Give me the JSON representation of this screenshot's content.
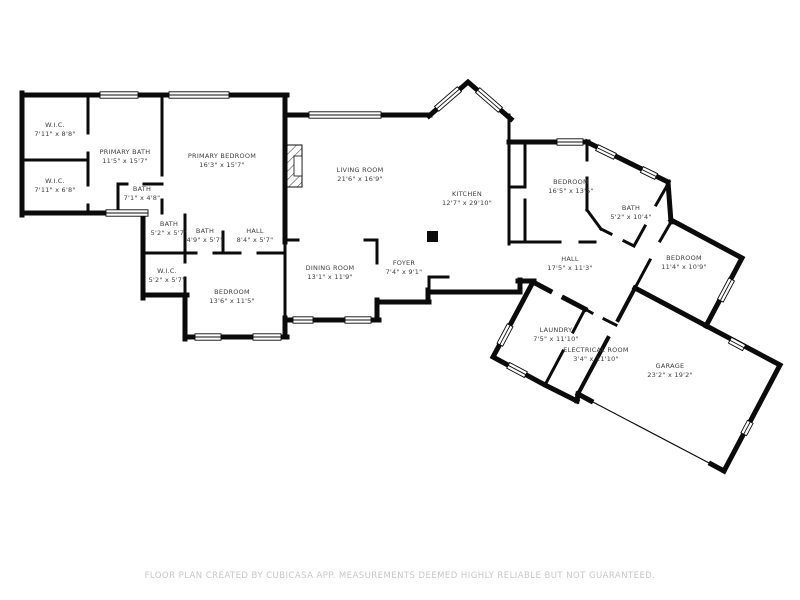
{
  "plan": {
    "app_credit": "CUBICASA",
    "footer": "FLOOR PLAN CREATED BY CUBICASA APP. MEASUREMENTS DEEMED HIGHLY RELIABLE BUT NOT GUARANTEED.",
    "colors": {
      "wall": "#0b0b0b",
      "label": "#3d3d3d",
      "footer_text": "#c7c7c7",
      "background": "#ffffff"
    },
    "rooms": [
      {
        "id": "wic-1",
        "name": "W.I.C.",
        "dims": "7'11\" x 8'8\""
      },
      {
        "id": "wic-2",
        "name": "W.I.C.",
        "dims": "7'11\" x 6'8\""
      },
      {
        "id": "primary-bath",
        "name": "PRIMARY BATH",
        "dims": "11'5\" x 15'7\""
      },
      {
        "id": "primary-bedroom",
        "name": "PRIMARY BEDROOM",
        "dims": "16'3\" x 15'7\""
      },
      {
        "id": "bath-small",
        "name": "BATH",
        "dims": "7'1\" x 4'8\""
      },
      {
        "id": "bath-2",
        "name": "BATH",
        "dims": "5'2\" x 5'7\""
      },
      {
        "id": "bath-3",
        "name": "BATH",
        "dims": "4'9\" x 5'7\""
      },
      {
        "id": "hall-1",
        "name": "HALL",
        "dims": "8'4\" x 5'7\""
      },
      {
        "id": "wic-3",
        "name": "W.I.C.",
        "dims": "5'2\" x 5'7\""
      },
      {
        "id": "bedroom-1",
        "name": "BEDROOM",
        "dims": "13'6\" x 11'5\""
      },
      {
        "id": "dining-room",
        "name": "DINING ROOM",
        "dims": "13'1\" x 11'9\""
      },
      {
        "id": "living-room",
        "name": "LIVING ROOM",
        "dims": "21'6\" x 16'9\""
      },
      {
        "id": "foyer",
        "name": "FOYER",
        "dims": "7'4\" x 9'1\""
      },
      {
        "id": "kitchen",
        "name": "KITCHEN",
        "dims": "12'7\" x 29'10\""
      },
      {
        "id": "bedroom-2",
        "name": "BEDROOM",
        "dims": "16'5\" x 13'5\""
      },
      {
        "id": "bath-4",
        "name": "BATH",
        "dims": "5'2\" x 10'4\""
      },
      {
        "id": "bedroom-3",
        "name": "BEDROOM",
        "dims": "11'4\" x 10'9\""
      },
      {
        "id": "hall-2",
        "name": "HALL",
        "dims": "17'5\" x 11'3\""
      },
      {
        "id": "laundry",
        "name": "LAUNDRY",
        "dims": "7'5\" x 11'10\""
      },
      {
        "id": "electrical-room",
        "name": "ELECTRICAL ROOM",
        "dims": "3'4\" x 11'10\""
      },
      {
        "id": "garage",
        "name": "GARAGE",
        "dims": "23'2\" x 19'2\""
      }
    ]
  }
}
